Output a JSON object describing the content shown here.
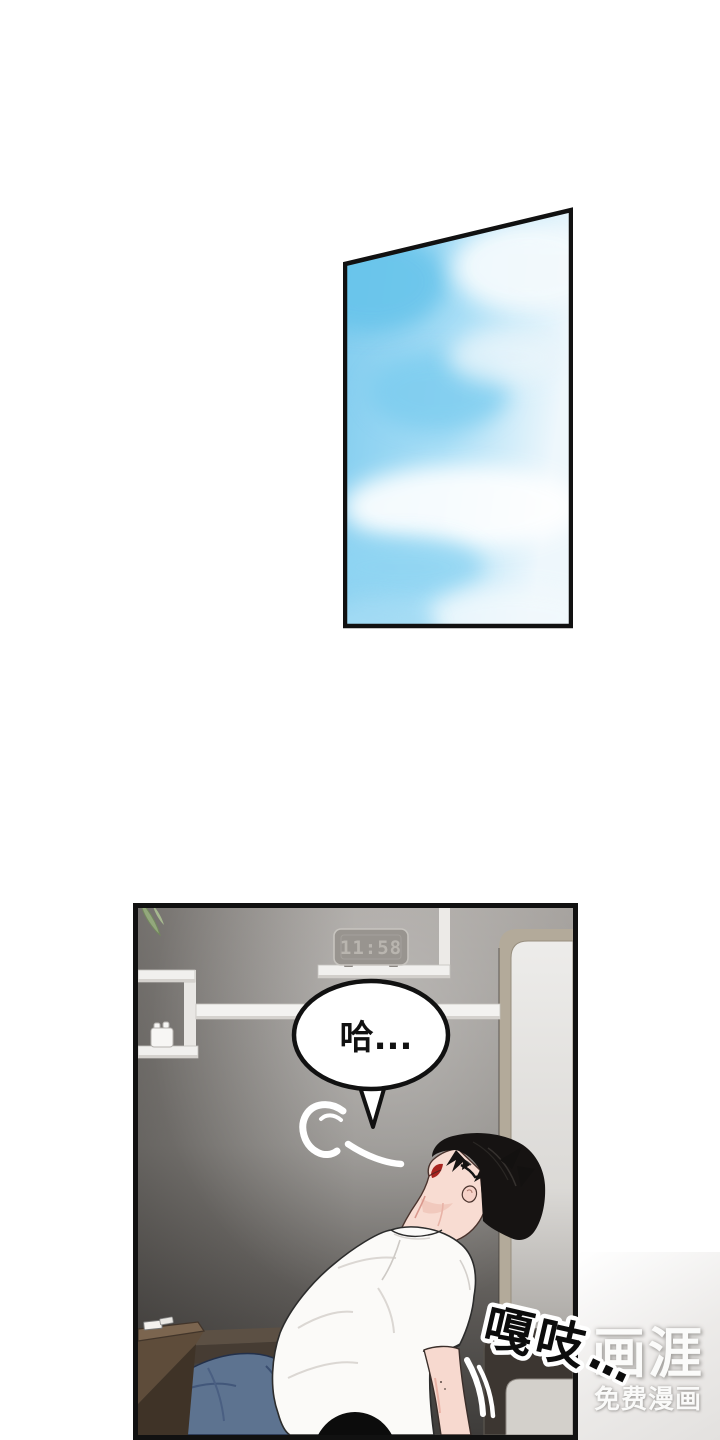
{
  "page": {
    "type": "comic-reader-page",
    "background_color": "#ffffff"
  },
  "panels": [
    {
      "id": "sky-panel",
      "description": "slanted borderless-content panel showing blue sky with soft clouds"
    },
    {
      "id": "room-panel",
      "description": "gray room with wall shelves, digital clock, door, desk and a black-haired man in white t-shirt and jeans leaning his head back"
    }
  ],
  "room_panel": {
    "clock_time": "11:58",
    "speech_bubble_text": "哈...",
    "sfx_text": "嘎吱",
    "sfx_dots": "..."
  },
  "watermark": {
    "logo": "画涯",
    "tagline": "免费漫画"
  },
  "colors": {
    "sky_blue": "#7ecbee",
    "wall_gray": "#8e8b87",
    "jeans_blue": "#5d7390",
    "shirt_white": "#fbfaf8",
    "hair_black": "#161312",
    "skin": "#f8dcd2",
    "mouth_red": "#a8241f",
    "panel_border": "#111111",
    "door_frame_tan": "#b3aa9a"
  }
}
